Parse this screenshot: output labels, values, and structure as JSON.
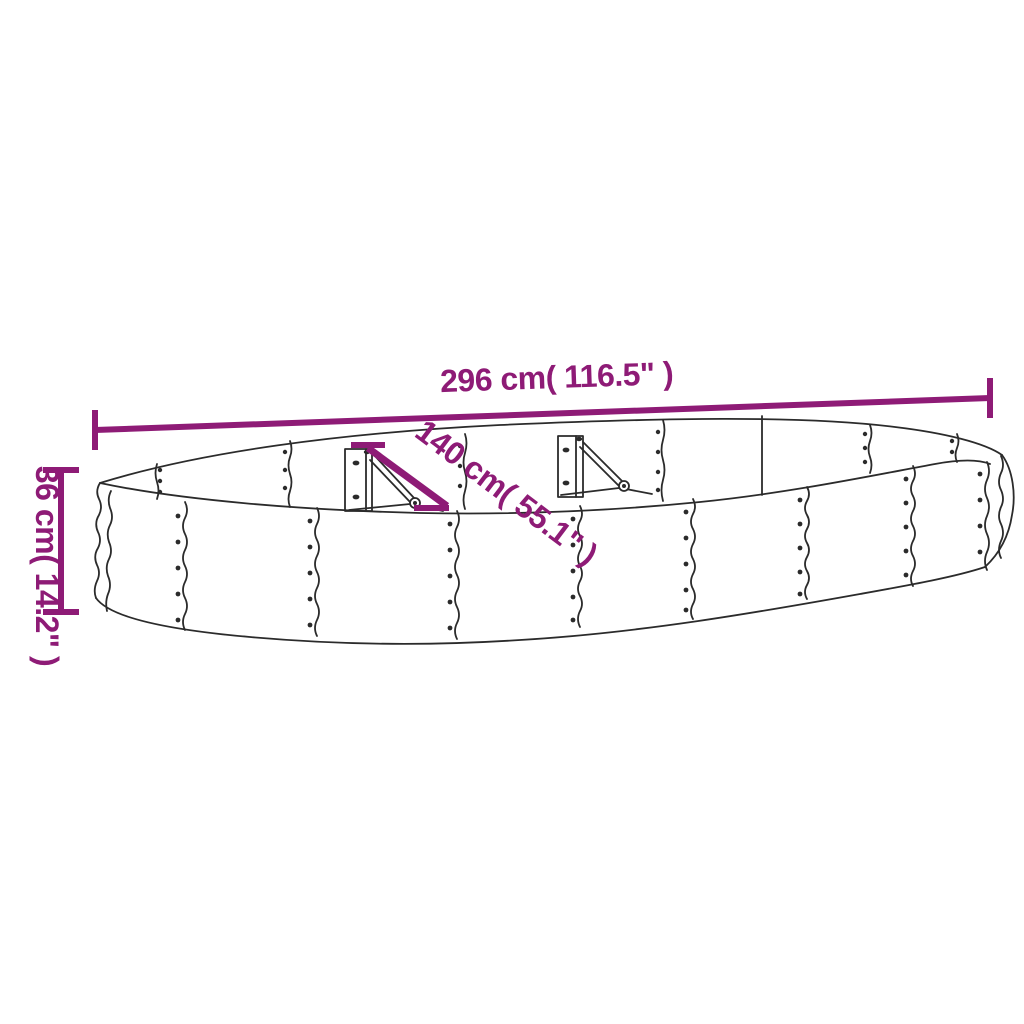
{
  "diagram": {
    "type": "product-dimension-diagram",
    "subject": "oval-raised-garden-bed",
    "dimensions": {
      "length": "296 cm( 116.5\" )",
      "width": "140 cm( 55.1\" )",
      "height": "36 cm( 14.2\" )"
    },
    "colors": {
      "dimension_annotation": "#8e1b76",
      "line_art": "#2b2b2b",
      "background": "#ffffff"
    }
  }
}
